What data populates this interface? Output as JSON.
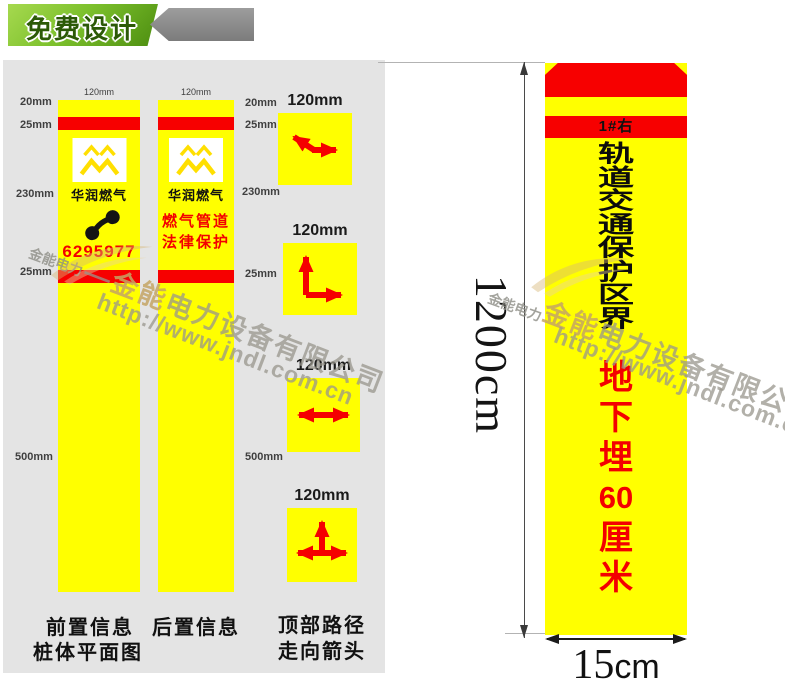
{
  "banner": {
    "title": "免费设计"
  },
  "colors": {
    "yellow": "#ffff00",
    "red": "#f70000",
    "panel_gray": "#e4e4e4",
    "banner_green": "#7cc02c",
    "tab_gray": "#8f8f8f",
    "arrow_red": "#f50000"
  },
  "panel": {
    "dims_left": [
      "20mm",
      "25mm",
      "230mm",
      "25mm",
      "500mm"
    ],
    "dims_right": [
      "20mm",
      "25mm",
      "230mm",
      "25mm",
      "500mm"
    ],
    "posts": {
      "front": {
        "width_label": "120mm",
        "brand": "华润燃气",
        "phone_number": "6295977",
        "caption1": "前置信息",
        "caption2": "桩体平面图"
      },
      "back": {
        "width_label": "120mm",
        "brand": "华润燃气",
        "red_line1": "燃气管道",
        "red_line2": "法律保护",
        "caption1": "后置信息"
      }
    },
    "tiles": {
      "label": "120mm",
      "caption1": "顶部路径",
      "caption2": "走向箭头"
    }
  },
  "pillar": {
    "tag": "1#右",
    "black_chars": [
      "轨",
      "道",
      "交",
      "通",
      "保",
      "护",
      "区",
      "界"
    ],
    "red_chars": [
      "地",
      "下",
      "埋",
      "60",
      "厘",
      "米"
    ],
    "height_label": "1200cm",
    "width_label_num": "15",
    "width_label_unit": "cm"
  },
  "watermark": {
    "small_brand": "金能电力",
    "dash": "—",
    "brand_gold": "金能",
    "company_rest": "电力设备有限公司",
    "url": "http://www.jndl.com.cn"
  }
}
